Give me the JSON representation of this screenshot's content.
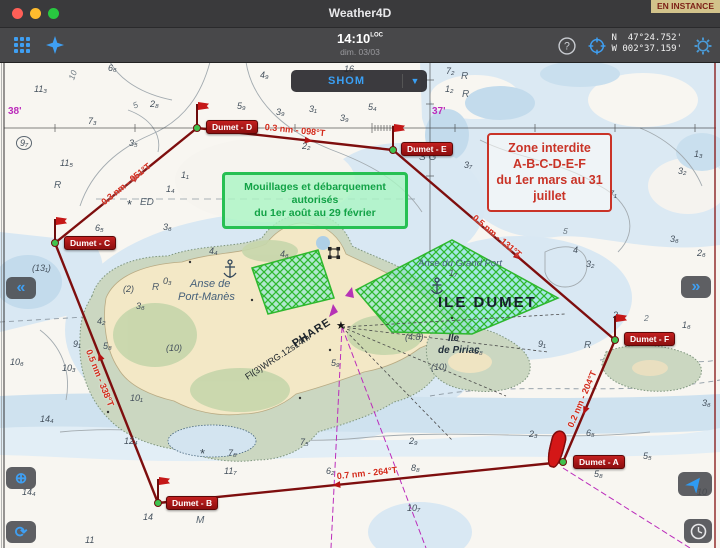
{
  "window": {
    "title": "Weather4D",
    "status_badge": "EN INSTANCE"
  },
  "toolbar": {
    "time": "14:10",
    "time_suffix": "LOC",
    "date": "dim. 03/03",
    "coords_line1": "N  47°24.752'",
    "coords_line2": "W 002°37.159'"
  },
  "chart": {
    "provider_button": {
      "label": "SHOM",
      "arrow": "▼"
    },
    "annotations": {
      "green_box": {
        "lines": [
          "Mouillages et débarquement",
          "autorisés",
          "du 1er août au 29 février"
        ]
      },
      "red_box": {
        "lines": [
          "Zone interdite",
          "A-B-C-D-E-F",
          "du 1er mars au 31",
          "juillet"
        ]
      }
    },
    "colors": {
      "route": "#7e0e0e",
      "leg_label": "#d32b1b",
      "hatch_green": "#2eb82e",
      "magenta": "#bb2cbb",
      "accent_blue": "#3f9ff2"
    },
    "waypoints": [
      {
        "label": "Dumet - A",
        "x": 563,
        "y": 462,
        "bx": 573,
        "by": 455,
        "icon": "boat"
      },
      {
        "label": "Dumet - B",
        "x": 158,
        "y": 503,
        "bx": 166,
        "by": 496,
        "icon": "flag"
      },
      {
        "label": "Dumet - C",
        "x": 55,
        "y": 243,
        "bx": 64,
        "by": 236,
        "icon": "flag"
      },
      {
        "label": "Dumet - D",
        "x": 197,
        "y": 128,
        "bx": 206,
        "by": 120,
        "icon": "flag"
      },
      {
        "label": "Dumet - E",
        "x": 393,
        "y": 150,
        "bx": 401,
        "by": 142,
        "icon": "flag"
      },
      {
        "label": "Dumet - F",
        "x": 615,
        "y": 340,
        "bx": 624,
        "by": 332,
        "icon": "flag"
      }
    ],
    "legs": [
      {
        "from": [
          563,
          462
        ],
        "to": [
          158,
          503
        ],
        "label": "0.7 nm - 264°T",
        "lx": 367,
        "ly": 473,
        "rot": -6
      },
      {
        "from": [
          158,
          503
        ],
        "to": [
          55,
          243
        ],
        "label": "0.5 nm - 338°T",
        "lx": 100,
        "ly": 378,
        "rot": 68
      },
      {
        "from": [
          55,
          243
        ],
        "to": [
          197,
          128
        ],
        "label": "0.3 nm - 051°T",
        "lx": 126,
        "ly": 184,
        "rot": -39
      },
      {
        "from": [
          197,
          128
        ],
        "to": [
          393,
          150
        ],
        "label": "0.3 nm - 098°T",
        "lx": 295,
        "ly": 130,
        "rot": 6
      },
      {
        "from": [
          393,
          150
        ],
        "to": [
          615,
          340
        ],
        "label": "0.5 nm - 131°T",
        "lx": 497,
        "ly": 236,
        "rot": 40
      },
      {
        "from": [
          615,
          340
        ],
        "to": [
          563,
          462
        ],
        "label": "0.2 nm - 204°T",
        "lx": 582,
        "ly": 399,
        "rot": -67
      }
    ],
    "place_labels": [
      {
        "t": "ILE DUMET",
        "x": 438,
        "y": 294,
        "cls": "ile-dumet"
      },
      {
        "t": "Anse de",
        "x": 190,
        "y": 278,
        "cls": "water"
      },
      {
        "t": "Port-Manès",
        "x": 178,
        "y": 291,
        "cls": "water"
      },
      {
        "t": "Anse du Grand Port",
        "x": 418,
        "y": 258,
        "cls": "water-sm"
      },
      {
        "t": "Ile",
        "x": 448,
        "y": 333,
        "cls": "islet"
      },
      {
        "t": "de Piriac",
        "x": 438,
        "y": 345,
        "cls": "islet"
      },
      {
        "t": "PHARE",
        "x": 290,
        "y": 327,
        "cls": "phare",
        "rot": -33
      },
      {
        "t": "Fl(3)WRG.12s14m",
        "x": 240,
        "y": 352,
        "cls": "phare-sm",
        "rot": -33
      },
      {
        "t": "ED",
        "x": 140,
        "y": 197,
        "cls": "gray-it"
      },
      {
        "t": "*",
        "x": 127,
        "y": 197,
        "cls": "star-sym"
      },
      {
        "t": "*",
        "x": 200,
        "y": 446,
        "cls": "star-sym"
      },
      {
        "t": "S G",
        "x": 419,
        "y": 152,
        "cls": "gray-it"
      },
      {
        "t": "M",
        "x": 196,
        "y": 515,
        "cls": "gray-it"
      },
      {
        "t": "R",
        "x": 54,
        "y": 180,
        "cls": "gray-it"
      },
      {
        "t": "R",
        "x": 152,
        "y": 282,
        "cls": "gray-it"
      },
      {
        "t": "R",
        "x": 462,
        "y": 89,
        "cls": "gray-it"
      },
      {
        "t": "R",
        "x": 461,
        "y": 71,
        "cls": "gray-it"
      },
      {
        "t": "R",
        "x": 584,
        "y": 340,
        "cls": "gray-it"
      },
      {
        "t": "38'",
        "x": 8,
        "y": 106,
        "cls": "magenta"
      },
      {
        "t": "37'",
        "x": 432,
        "y": 106,
        "cls": "magenta"
      },
      {
        "t": "★",
        "x": 336,
        "y": 319,
        "cls": "lighthouse"
      },
      {
        "t": "10",
        "x": 68,
        "y": 70,
        "cls": "contour-label",
        "rot": -70
      },
      {
        "t": "5",
        "x": 133,
        "y": 100,
        "cls": "contour-label",
        "rot": -25
      },
      {
        "t": "5",
        "x": 563,
        "y": 226,
        "cls": "contour-label",
        "rot": 8
      },
      {
        "t": "2",
        "x": 644,
        "y": 313,
        "cls": "contour-label"
      }
    ],
    "depths": [
      {
        "t": "11₃",
        "x": 34,
        "y": 84
      },
      {
        "t": "7₃",
        "x": 88,
        "y": 116
      },
      {
        "t": "9₇",
        "x": 16,
        "y": 136,
        "c": "circ"
      },
      {
        "t": "11₅",
        "x": 60,
        "y": 158
      },
      {
        "t": "6₆",
        "x": 108,
        "y": 63
      },
      {
        "t": "16",
        "x": 344,
        "y": 64
      },
      {
        "t": "4₉",
        "x": 260,
        "y": 70
      },
      {
        "t": "5₉",
        "x": 237,
        "y": 101
      },
      {
        "t": "3₉",
        "x": 276,
        "y": 107
      },
      {
        "t": "3₁",
        "x": 309,
        "y": 104
      },
      {
        "t": "3₉",
        "x": 340,
        "y": 113
      },
      {
        "t": "5₄",
        "x": 368,
        "y": 102
      },
      {
        "t": "2₂",
        "x": 302,
        "y": 141
      },
      {
        "t": "2₈",
        "x": 150,
        "y": 99
      },
      {
        "t": "3₅",
        "x": 129,
        "y": 138
      },
      {
        "t": "1₁",
        "x": 181,
        "y": 170
      },
      {
        "t": "1₄",
        "x": 166,
        "y": 184
      },
      {
        "t": "3₆",
        "x": 163,
        "y": 222
      },
      {
        "t": "6₅",
        "x": 95,
        "y": 223
      },
      {
        "t": "7₂",
        "x": 446,
        "y": 66
      },
      {
        "t": "1₂",
        "x": 445,
        "y": 84
      },
      {
        "t": "3₇",
        "x": 464,
        "y": 160
      },
      {
        "t": "1₃",
        "x": 694,
        "y": 149
      },
      {
        "t": "3₂",
        "x": 678,
        "y": 166
      },
      {
        "t": "7₁",
        "x": 609,
        "y": 189
      },
      {
        "t": "4",
        "x": 573,
        "y": 245
      },
      {
        "t": "3₂",
        "x": 586,
        "y": 259
      },
      {
        "t": "3₆",
        "x": 670,
        "y": 234
      },
      {
        "t": "2₆",
        "x": 697,
        "y": 248
      },
      {
        "t": "2₉",
        "x": 613,
        "y": 310
      },
      {
        "t": "1₆",
        "x": 682,
        "y": 320
      },
      {
        "t": "(4.8)",
        "x": 405,
        "y": 332
      },
      {
        "t": "(10)",
        "x": 431,
        "y": 362
      },
      {
        "t": "5₈",
        "x": 474,
        "y": 346
      },
      {
        "t": "5₉",
        "x": 331,
        "y": 358
      },
      {
        "t": "(10)",
        "x": 166,
        "y": 343
      },
      {
        "t": "(2)",
        "x": 123,
        "y": 284
      },
      {
        "t": "3₆",
        "x": 136,
        "y": 301
      },
      {
        "t": "0₃",
        "x": 163,
        "y": 276
      },
      {
        "t": "4₄",
        "x": 209,
        "y": 246
      },
      {
        "t": "4₆",
        "x": 280,
        "y": 249
      },
      {
        "t": "1₇",
        "x": 449,
        "y": 268
      },
      {
        "t": "(13₁)",
        "x": 32,
        "y": 263
      },
      {
        "t": "10₆",
        "x": 10,
        "y": 357
      },
      {
        "t": "10₃",
        "x": 62,
        "y": 363
      },
      {
        "t": "9₁",
        "x": 73,
        "y": 339
      },
      {
        "t": "5₈",
        "x": 103,
        "y": 341
      },
      {
        "t": "4₂",
        "x": 97,
        "y": 316
      },
      {
        "t": "10₁",
        "x": 130,
        "y": 393
      },
      {
        "t": "12₄",
        "x": 124,
        "y": 436
      },
      {
        "t": "14₄",
        "x": 40,
        "y": 414
      },
      {
        "t": "14₄",
        "x": 22,
        "y": 487
      },
      {
        "t": "14",
        "x": 143,
        "y": 512
      },
      {
        "t": "11",
        "x": 85,
        "y": 535
      },
      {
        "t": "7₈",
        "x": 228,
        "y": 448
      },
      {
        "t": "7₅",
        "x": 300,
        "y": 437
      },
      {
        "t": "11₇",
        "x": 224,
        "y": 466
      },
      {
        "t": "6₂",
        "x": 326,
        "y": 466
      },
      {
        "t": "2₉",
        "x": 409,
        "y": 436
      },
      {
        "t": "8₈",
        "x": 411,
        "y": 463
      },
      {
        "t": "10₇",
        "x": 407,
        "y": 503
      },
      {
        "t": "2₃",
        "x": 529,
        "y": 429
      },
      {
        "t": "6₅",
        "x": 586,
        "y": 428
      },
      {
        "t": "5₅",
        "x": 643,
        "y": 451
      },
      {
        "t": "5₈",
        "x": 594,
        "y": 469
      },
      {
        "t": "3₆",
        "x": 702,
        "y": 398
      },
      {
        "t": "10",
        "x": 697,
        "y": 487
      },
      {
        "t": "9₁",
        "x": 538,
        "y": 339
      }
    ]
  },
  "side_buttons": {
    "prev": "«",
    "next": "»",
    "locate": "⊕",
    "refresh": "⟳"
  }
}
